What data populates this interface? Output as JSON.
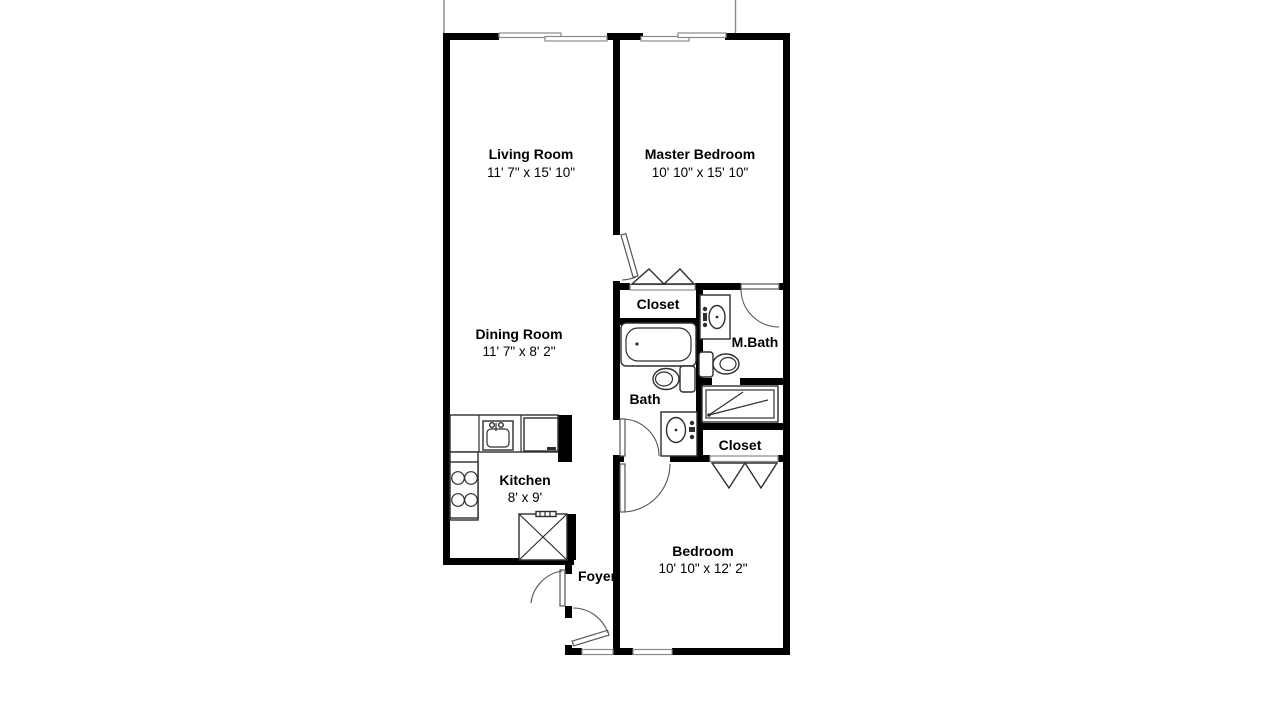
{
  "colors": {
    "wall": "#000000",
    "window_line": "#8a8a8a",
    "fixture_line": "#2e2e2e",
    "door_line": "#555555",
    "text": "#000000",
    "background": "#ffffff"
  },
  "rooms": {
    "living_room": {
      "name": "Living Room",
      "dims": "11' 7\" x 15' 10\""
    },
    "master_bedroom": {
      "name": "Master Bedroom",
      "dims": "10' 10\" x 15' 10\""
    },
    "dining_room": {
      "name": "Dining Room",
      "dims": "11' 7\" x 8' 2\""
    },
    "kitchen": {
      "name": "Kitchen",
      "dims": "8' x 9'"
    },
    "bedroom": {
      "name": "Bedroom",
      "dims": "10' 10\" x 12' 2\""
    },
    "foyer": {
      "name": "Foyer"
    },
    "bath": {
      "name": "Bath"
    },
    "master_bath": {
      "name": "M.Bath"
    },
    "hall_closet": {
      "name": "Closet"
    },
    "bedroom_closet": {
      "name": "Closet"
    }
  }
}
